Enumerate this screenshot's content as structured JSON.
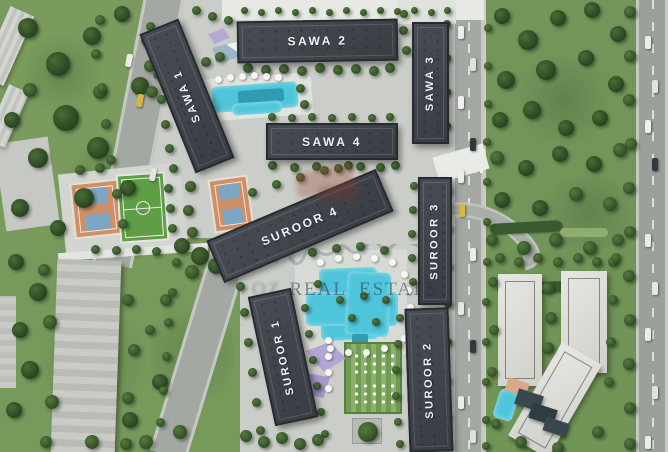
{
  "scene": {
    "type": "aerial-masterplan-render"
  },
  "buildings": {
    "sawa1": {
      "label": "SAWA 1"
    },
    "sawa2": {
      "label": "SAWA 2"
    },
    "sawa3": {
      "label": "SAWA 3"
    },
    "sawa4": {
      "label": "SAWA 4"
    },
    "suroor1": {
      "label": "SUROOR 1"
    },
    "suroor2": {
      "label": "SUROOR 2"
    },
    "suroor3": {
      "label": "SUROOR 3"
    },
    "suroor4": {
      "label": "SUROOR 4"
    }
  },
  "watermark": {
    "prefix": "OZ",
    "text": "REAL ESTATE"
  },
  "palette": {
    "building_roof": "#3e434a",
    "label_text": "#f2f3f4",
    "grass": "#77985b",
    "tree": "#30502a",
    "pool": "#4ec5db",
    "road": "#a3a8a2",
    "pavement": "#cbcec8",
    "court_clay": "#cf8f67",
    "court_blue": "#7ba6c4",
    "pitch_green": "#5f9d46",
    "canopy_purple": "#b2a3d3",
    "white_roof": "#dfe0db"
  }
}
